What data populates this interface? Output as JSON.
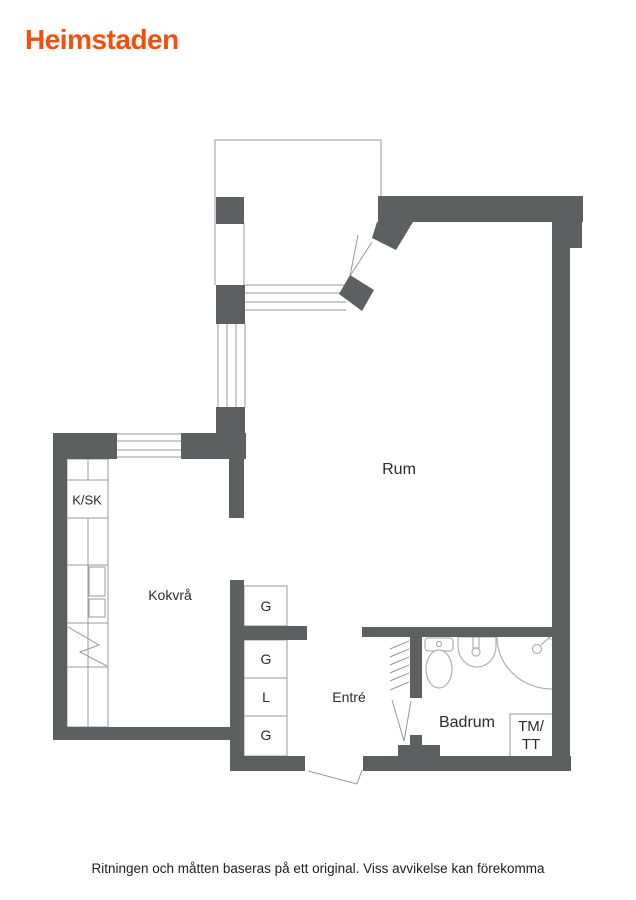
{
  "colors": {
    "brand": "#f84e0c",
    "wall": "#5e5f61",
    "line": "#9a9a9a",
    "fixture": "#b0b0b0",
    "text": "#2b2b2b"
  },
  "header": {
    "logo": "Heimstaden"
  },
  "floorplan": {
    "labels": {
      "rum": "Rum",
      "kokvra": "Kokvrå",
      "ksk": "K/SK",
      "g_top": "G",
      "g_mid": "G",
      "l": "L",
      "g_bottom": "G",
      "entre": "Entré",
      "badrum": "Badrum",
      "tmtt_line1": "TM/",
      "tmtt_line2": "TT"
    }
  },
  "footer": {
    "disclaimer": "Ritningen och måtten baseras på ett original. Viss avvikelse kan förekomma"
  }
}
